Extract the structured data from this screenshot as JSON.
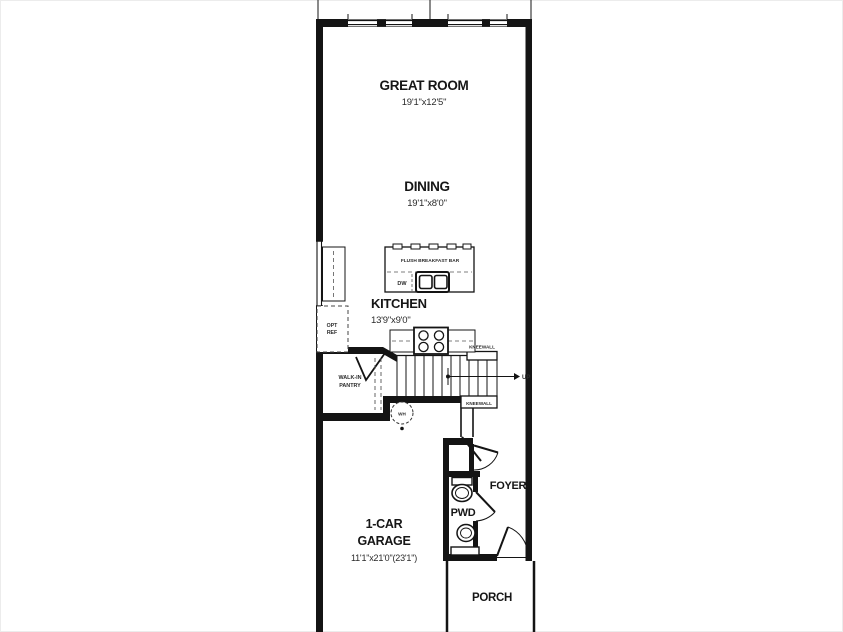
{
  "floorplan": {
    "title": "Townhome first floor plan",
    "colors": {
      "line": "#141414",
      "background": "#ffffff"
    },
    "rooms": {
      "great_room": {
        "name": "GREAT ROOM",
        "dims": "19'1\"x12'5\""
      },
      "dining": {
        "name": "DINING",
        "dims": "19'1\"x8'0\""
      },
      "kitchen": {
        "name": "KITCHEN",
        "dims": "13'9\"x9'0\""
      },
      "garage": {
        "name_line1": "1-CAR",
        "name_line2": "GARAGE",
        "dims": "11'1\"x21'0\"(23'1\")"
      },
      "pantry": {
        "name_line1": "WALK-IN",
        "name_line2": "PANTRY"
      },
      "foyer": {
        "name": "FOYER"
      },
      "pwd": {
        "name": "PWD"
      },
      "porch": {
        "name": "PORCH"
      }
    },
    "labels": {
      "breakfast_bar": "FLUSH BREAKFAST BAR",
      "dishwasher": "DW",
      "water_heater": "WH",
      "up": "UP",
      "kneewall_upper": "KNEEWALL",
      "kneewall_lower": "KNEEWALL",
      "opt_ref_line1": "OPT",
      "opt_ref_line2": "REF"
    }
  }
}
